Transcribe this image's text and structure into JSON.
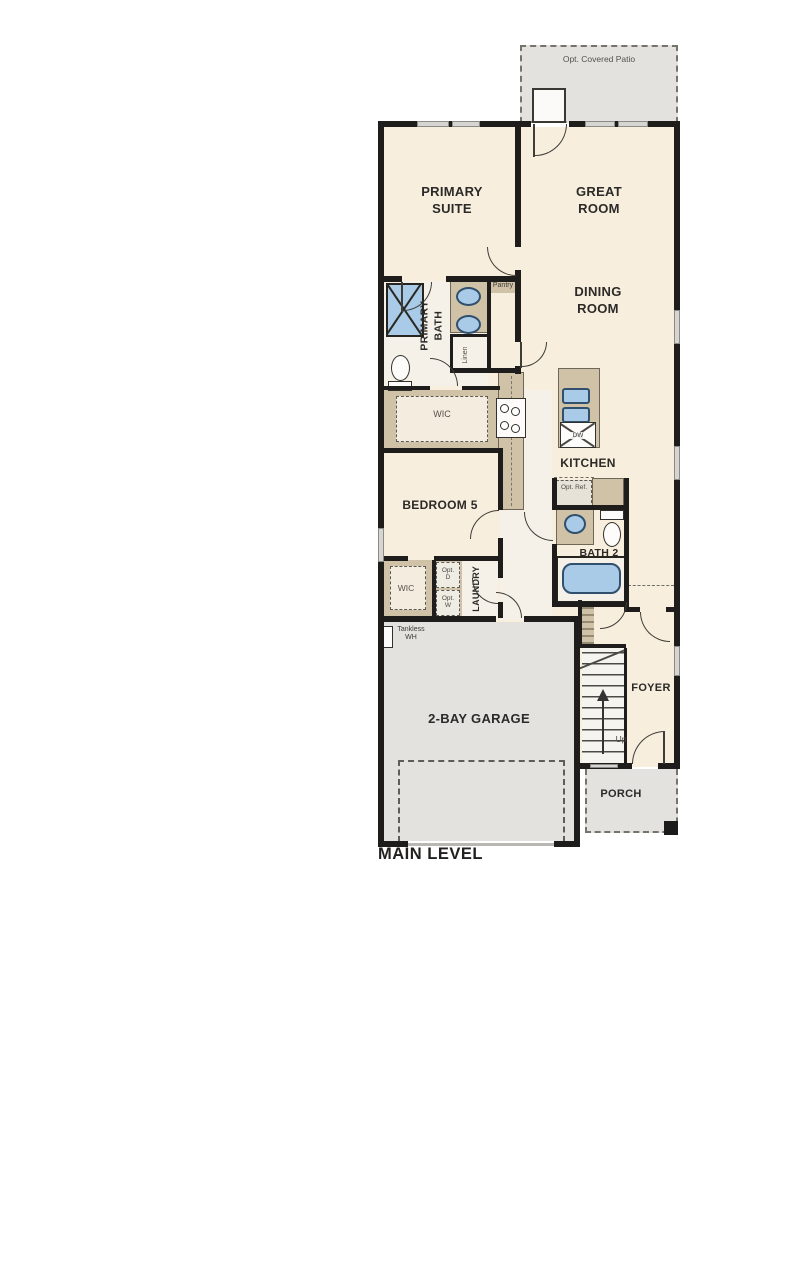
{
  "plan": {
    "title": "MAIN LEVEL",
    "rooms": {
      "patio": "Opt. Covered Patio",
      "primary_suite": "PRIMARY SUITE",
      "great_room": "GREAT ROOM",
      "dining_room": "DINING ROOM",
      "primary_bath": "PRIMARY BATH",
      "pantry": "Pantry",
      "linen": "Linen",
      "wic_primary": "WIC",
      "kitchen": "KITCHEN",
      "bedroom_5": "BEDROOM 5",
      "bath_2": "BATH 2",
      "wic_bedroom": "WIC",
      "laundry": "LAUNDRY",
      "garage": "2-BAY GARAGE",
      "foyer": "FOYER",
      "porch": "PORCH"
    },
    "annotations": {
      "dishwasher": "DW",
      "opt_ref": "Opt. Ref.",
      "opt_dryer": "Opt. D",
      "opt_washer": "Opt. W",
      "tankless_wh": "Tankless WH",
      "stairs_up": "Up"
    },
    "colors": {
      "wall": "#1f1d1b",
      "room_fill": "#f7eedd",
      "cabinet_tan": "#cfc2a6",
      "exterior_gray": "#e3e2df",
      "fixture_blue": "#a9cbe7"
    }
  }
}
